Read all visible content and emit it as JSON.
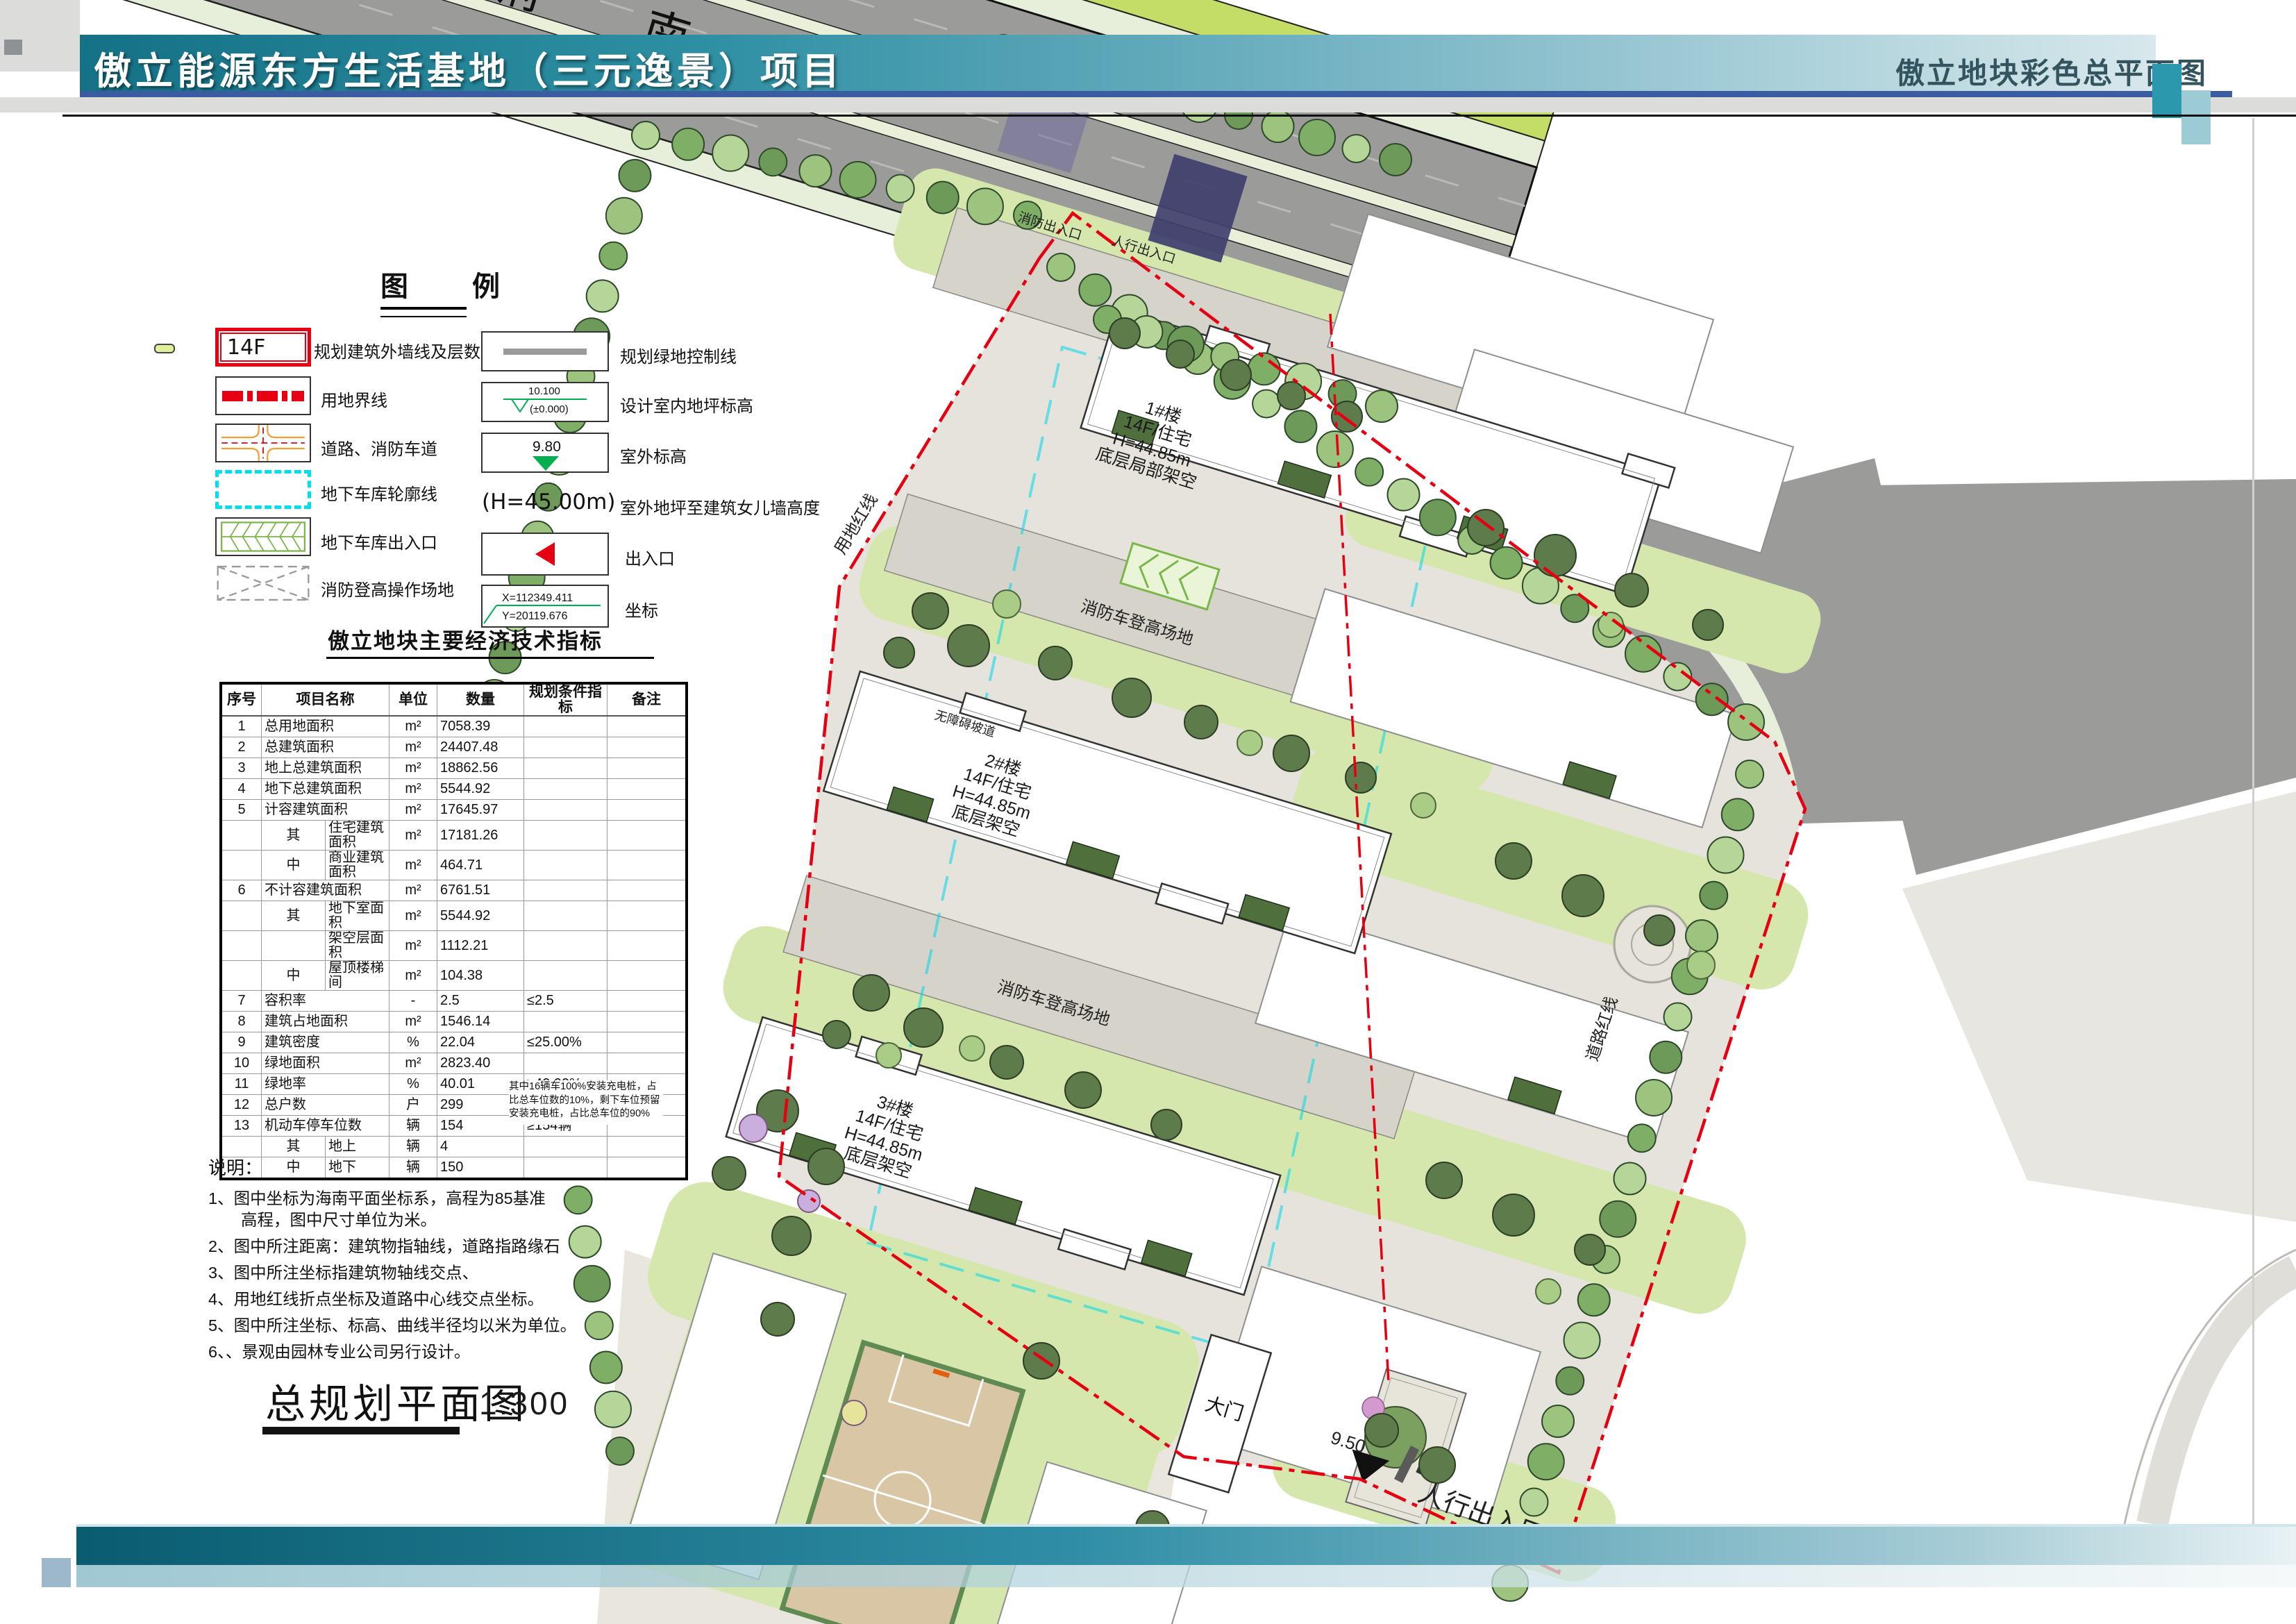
{
  "header": {
    "left_title": "傲立能源东方生活基地（三元逸景）项目",
    "right_title": "傲立地块彩色总平面图"
  },
  "legend": {
    "title": "图　例",
    "items_left": [
      {
        "id": "building-outline",
        "symbol_text": "14F",
        "label": "规划建筑外墙线及层数"
      },
      {
        "id": "land-boundary",
        "label": "用地界线"
      },
      {
        "id": "road-firelane",
        "label": "道路、消防车道"
      },
      {
        "id": "garage-outline",
        "label": "地下车库轮廓线"
      },
      {
        "id": "garage-entrance",
        "label": "地下车库出入口"
      },
      {
        "id": "fire-operation-area",
        "label": "消防登高操作场地"
      }
    ],
    "items_right": [
      {
        "id": "green-control-line",
        "label": "规划绿地控制线"
      },
      {
        "id": "indoor-floor-elevation",
        "value_top": "10.100",
        "value_bottom": "(±0.000)",
        "label": "设计室内地坪标高"
      },
      {
        "id": "outdoor-elevation",
        "value": "9.80",
        "label": "室外标高"
      },
      {
        "id": "parapet-height",
        "value": "(H=45.00m)",
        "label": "室外地坪至建筑女儿墙高度"
      },
      {
        "id": "entrance",
        "label": "出入口"
      },
      {
        "id": "coordinate",
        "value_x": "X=112349.411",
        "value_y": "Y=20119.676",
        "label": "坐标"
      }
    ]
  },
  "indicators": {
    "title": "傲立地块主要经济技术指标",
    "columns": [
      "序号",
      "项目名称",
      "单位",
      "数量",
      "规划条件指标",
      "备注"
    ],
    "rows": [
      {
        "no": "1",
        "name": "总用地面积",
        "unit": "m²",
        "qty": "7058.39"
      },
      {
        "no": "2",
        "name": "总建筑面积",
        "unit": "m²",
        "qty": "24407.48"
      },
      {
        "no": "3",
        "name": "地上总建筑面积",
        "unit": "m²",
        "qty": "18862.56"
      },
      {
        "no": "4",
        "name": "地下总建筑面积",
        "unit": "m²",
        "qty": "5544.92"
      },
      {
        "no": "5",
        "name": "计容建筑面积",
        "unit": "m²",
        "qty": "17645.97"
      },
      {
        "no": "",
        "sub": "其",
        "name": "住宅建筑面积",
        "unit": "m²",
        "qty": "17181.26"
      },
      {
        "no": "",
        "sub": "中",
        "name": "商业建筑面积",
        "unit": "m²",
        "qty": "464.71"
      },
      {
        "no": "6",
        "name": "不计容建筑面积",
        "unit": "m²",
        "qty": "6761.51"
      },
      {
        "no": "",
        "sub": "其",
        "name": "地下室面积",
        "unit": "m²",
        "qty": "5544.92"
      },
      {
        "no": "",
        "sub": "",
        "name": "架空层面积",
        "unit": "m²",
        "qty": "1112.21"
      },
      {
        "no": "",
        "sub": "中",
        "name": "屋顶楼梯间",
        "unit": "m²",
        "qty": "104.38"
      },
      {
        "no": "7",
        "name": "容积率",
        "unit": "-",
        "qty": "2.5",
        "req": "≤2.5"
      },
      {
        "no": "8",
        "name": "建筑占地面积",
        "unit": "m²",
        "qty": "1546.14"
      },
      {
        "no": "9",
        "name": "建筑密度",
        "unit": "%",
        "qty": "22.04",
        "req": "≤25.00%"
      },
      {
        "no": "10",
        "name": "绿地面积",
        "unit": "m²",
        "qty": "2823.40"
      },
      {
        "no": "11",
        "name": "绿地率",
        "unit": "%",
        "qty": "40.01",
        "req": "≥40.00%"
      },
      {
        "no": "12",
        "name": "总户数",
        "unit": "户",
        "qty": "299"
      },
      {
        "no": "13",
        "name": "机动车停车位数",
        "unit": "辆",
        "qty": "154",
        "req": "≥154辆"
      },
      {
        "no": "",
        "sub": "其",
        "name": "地上",
        "unit": "辆",
        "qty": "4"
      },
      {
        "no": "",
        "sub": "中",
        "name": "地下",
        "unit": "辆",
        "qty": "150"
      }
    ],
    "remark_note": "其中16辆车100%安装充电桩，占比总车位数的10%，剩下车位预留安装充电桩，占比总车位的90%"
  },
  "notes": {
    "title": "说明：",
    "items": [
      "1、图中坐标为海南平面坐标系，高程为85基准\n　　高程，图中尺寸单位为米。",
      "2、图中所注距离：建筑物指轴线，道路指路缘石",
      "3、图中所注坐标指建筑物轴线交点、",
      "4、用地红线折点坐标及道路中心线交点坐标。",
      "5、图中所注坐标、标高、曲线半径均以米为单位。",
      "6、、景观由园林专业公司另行设计。"
    ]
  },
  "plan": {
    "caption": "总规划平面图",
    "scale": "1:300",
    "road_name": "东府南路",
    "buildings": [
      {
        "name": "1#楼",
        "use": "14F/住宅",
        "height": "H=44.85m",
        "note": "底层局部架空"
      },
      {
        "name": "2#楼",
        "use": "14F/住宅",
        "height": "H=44.85m",
        "note": "底层架空"
      },
      {
        "name": "3#楼",
        "use": "14F/住宅",
        "height": "H=44.85m",
        "note": "底层架空"
      }
    ],
    "labels": {
      "fire_ladder_area": "消防车登高场地",
      "land_redline": "用地红线",
      "road_redline": "道路红线",
      "fire_entrance": "消防出入口",
      "ped_entrance_top": "人行出入口",
      "barrier_free_ramp": "无障碍坡道",
      "gate": "大门",
      "ped_entrance": "人行出入口",
      "elevation_marker": "9.50"
    }
  },
  "colors": {
    "header_teal": "#157286",
    "header_blue_line": "#3c5ca2",
    "redline": "#e60012",
    "garage_cyan": "#00dff0",
    "green_symbol": "#00b050",
    "road_gray": "#9b9b99"
  }
}
